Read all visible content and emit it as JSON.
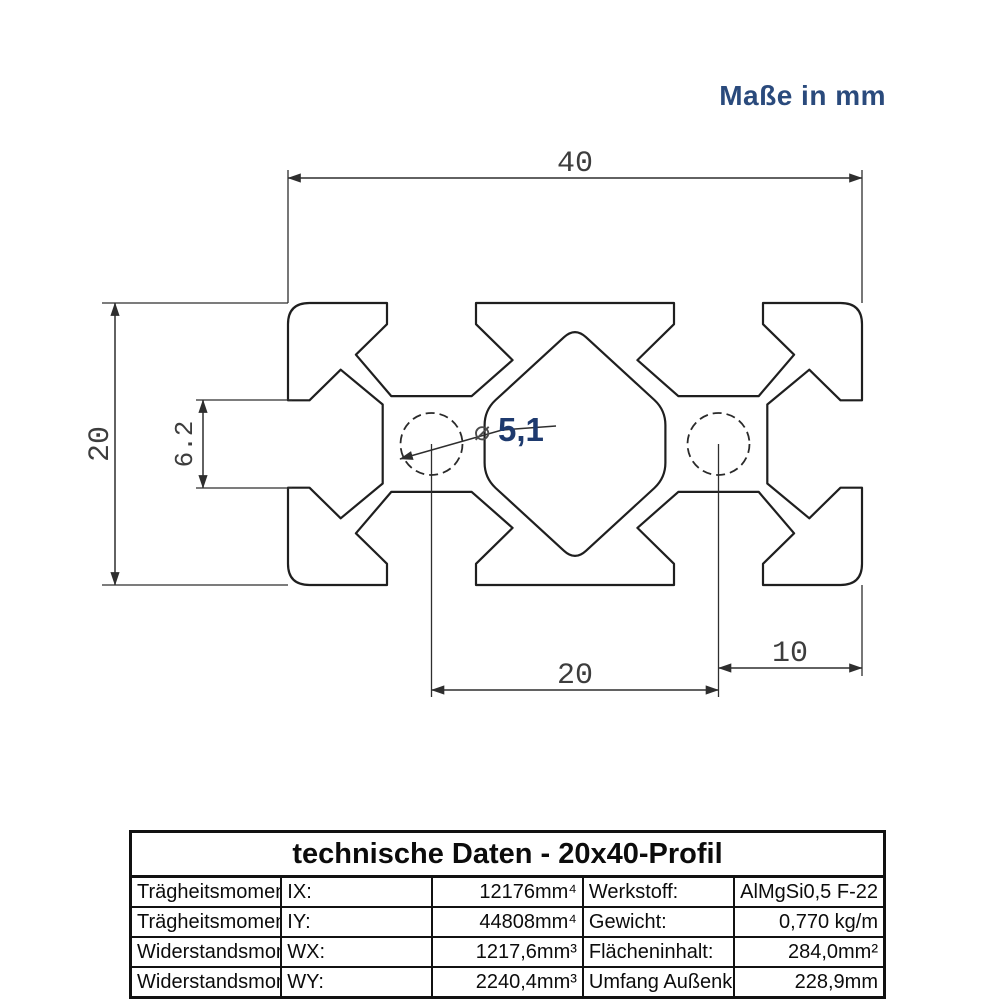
{
  "note": {
    "text": "Maße in mm"
  },
  "colors": {
    "accent_navy": "#2a4a7c",
    "dimension_blue": "#1e3a6e",
    "line_black": "#1f1f1f"
  },
  "drawing": {
    "title": "20x40 aluminium extrusion profile cross-section",
    "dimensions": {
      "overall_width": "40",
      "overall_height": "20",
      "slot_opening": "6.2",
      "hole_diameter_symbol": "⌀",
      "hole_diameter": "5,1",
      "hole_center_spacing": "20",
      "hole_edge_spacing": "10"
    }
  },
  "table": {
    "title": "technische Daten - 20x40-Profil",
    "rows": [
      {
        "property": "Trägheitsmoment",
        "symbol": "IX:",
        "value": "12176mm⁴",
        "property2": "Werkstoff:",
        "value2": "AlMgSi0,5 F-22"
      },
      {
        "property": "Trägheitsmoment",
        "symbol": "IY:",
        "value": "44808mm⁴",
        "property2": "Gewicht:",
        "value2": "0,770 kg/m"
      },
      {
        "property": "Widerstandsmoment",
        "symbol": "WX:",
        "value": "1217,6mm³",
        "property2": "Flächeninhalt:",
        "value2": "284,0mm²"
      },
      {
        "property": "Widerstandsmoment",
        "symbol": "WY:",
        "value": "2240,4mm³",
        "property2": "Umfang Außenkontur:",
        "value2": "228,9mm"
      }
    ]
  }
}
